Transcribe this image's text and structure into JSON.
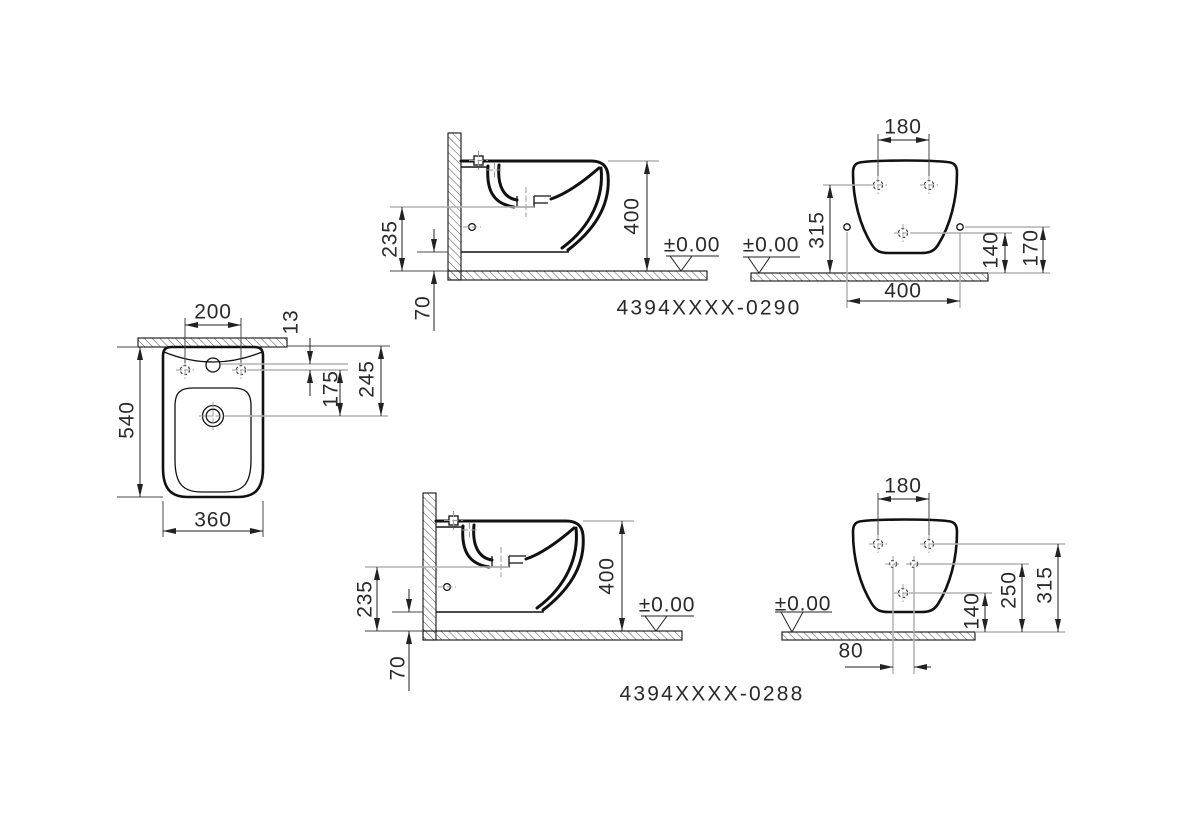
{
  "drawing": {
    "kind": "wall-hung bidet installation drawing, three orthographic views per model",
    "colors": {
      "background": "#ffffff",
      "outline": "#111111",
      "dimension": "#222222",
      "extension": "#b2b2b2",
      "text": "#2a2a2a"
    },
    "views": {
      "side_top": {
        "code": "4394XXXX-0290",
        "dim_235": "235",
        "dim_400": "400",
        "dim_70": "70",
        "datum": "±0.00"
      },
      "front_top": {
        "dim_180": "180",
        "dim_315": "315",
        "dim_140": "140",
        "dim_170": "170",
        "dim_400": "400",
        "datum": "±0.00"
      },
      "plan": {
        "dim_200": "200",
        "dim_13": "13",
        "dim_175": "175",
        "dim_245": "245",
        "dim_540": "540",
        "dim_360": "360"
      },
      "side_bottom": {
        "code": "4394XXXX-0288",
        "dim_235": "235",
        "dim_400": "400",
        "dim_70": "70",
        "datum": "±0.00"
      },
      "front_bottom": {
        "dim_180": "180",
        "dim_315": "315",
        "dim_250": "250",
        "dim_140": "140",
        "dim_80": "80",
        "datum": "±0.00"
      }
    }
  }
}
